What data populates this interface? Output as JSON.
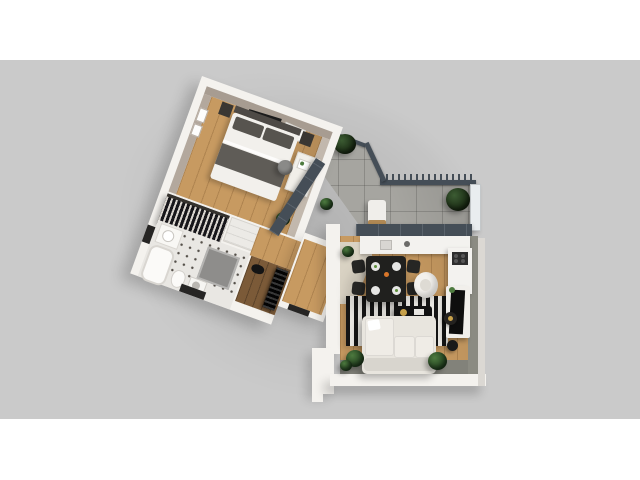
{
  "image": {
    "kind": "3D architectural floor plan render",
    "view": "top-down bird's-eye axonometric",
    "letterboxed": true,
    "visible_text": "none"
  },
  "palette": {
    "letterbox": "#ffffff",
    "bg": "#cacaca",
    "wall": "#f4f2ee",
    "wallshade": "#dbd8d3",
    "taupe1": "#a79c91",
    "taupe2": "#b3a89d",
    "taupe3": "#c2b8ad",
    "wood": "#c79a61",
    "woodline": "rgba(90,55,20,0.22)",
    "wooddark": "#7b5a38",
    "tile": "#a6a5a0",
    "tileline": "rgba(60,60,58,0.25)",
    "slate": "#454e57",
    "slate2": "#5a636c",
    "bathfloor": "#e9e7e3",
    "shower": "#8e8d8b",
    "olive": "#82827a",
    "olive2": "#8b8b82",
    "beige": "#d9d2c3",
    "rugdark": "#151515",
    "ruglight": "#e9e7e2",
    "sofa": "#e8e5de",
    "sofa2": "#d8d5ce",
    "sofa3": "#efece6",
    "dark": "#20201e",
    "counter": "#f3f2ef",
    "plant": "#4d7a3f",
    "plantdark": "#1e3a1c",
    "glass": "#e9edef"
  },
  "scene": {
    "description": "One-bedroom apartment rendered from above on a grey backdrop; rotated bedroom/bathroom wing upper-left, open living-kitchen wing lower-right, wrap-around grey-tiled balcony between them",
    "rooms": [
      {
        "name": "bedroom",
        "floor": "oak wood planks",
        "walls": "taupe",
        "furniture": [
          "double bed with white duvet and dark grey pillows and throw",
          "two dark nightstands",
          "wall-mounted TV panel",
          "white wall frame",
          "desk with grey chair",
          "two framed pictures on wall",
          "open wardrobe with hanging clothes",
          "white wardrobe unit",
          "potted plant"
        ]
      },
      {
        "name": "bathroom",
        "floor": "white tile with dark mosaic dots",
        "furniture": [
          "walk-in shower with grey tray",
          "bathtub",
          "vanity with round basin",
          "toilet",
          "washing machine"
        ]
      },
      {
        "name": "hallway-entry",
        "floor": "dark wood",
        "furniture": [
          "radiator",
          "dark bag",
          "door openings in outer wall"
        ]
      },
      {
        "name": "living-room-kitchen",
        "floor": "oak wood with beige tile at entry",
        "furniture": [
          "white kitchen counter under window",
          "kitchen run with dark cooktop",
          "black dining table with four plates",
          "four black dining chairs",
          "white egg chair",
          "black-and-white striped rug",
          "black coffee table with gold tray",
          "light grey L-shaped sofa",
          "white TV sideboard",
          "black television",
          "black floor lamp",
          "round side stool",
          "corner potted plants"
        ]
      },
      {
        "name": "balcony",
        "floor": "grey stone tiles",
        "furniture": [
          "dark metal railing with slats",
          "white glass divider panel",
          "white lounge chair",
          "three potted plants"
        ]
      }
    ]
  }
}
